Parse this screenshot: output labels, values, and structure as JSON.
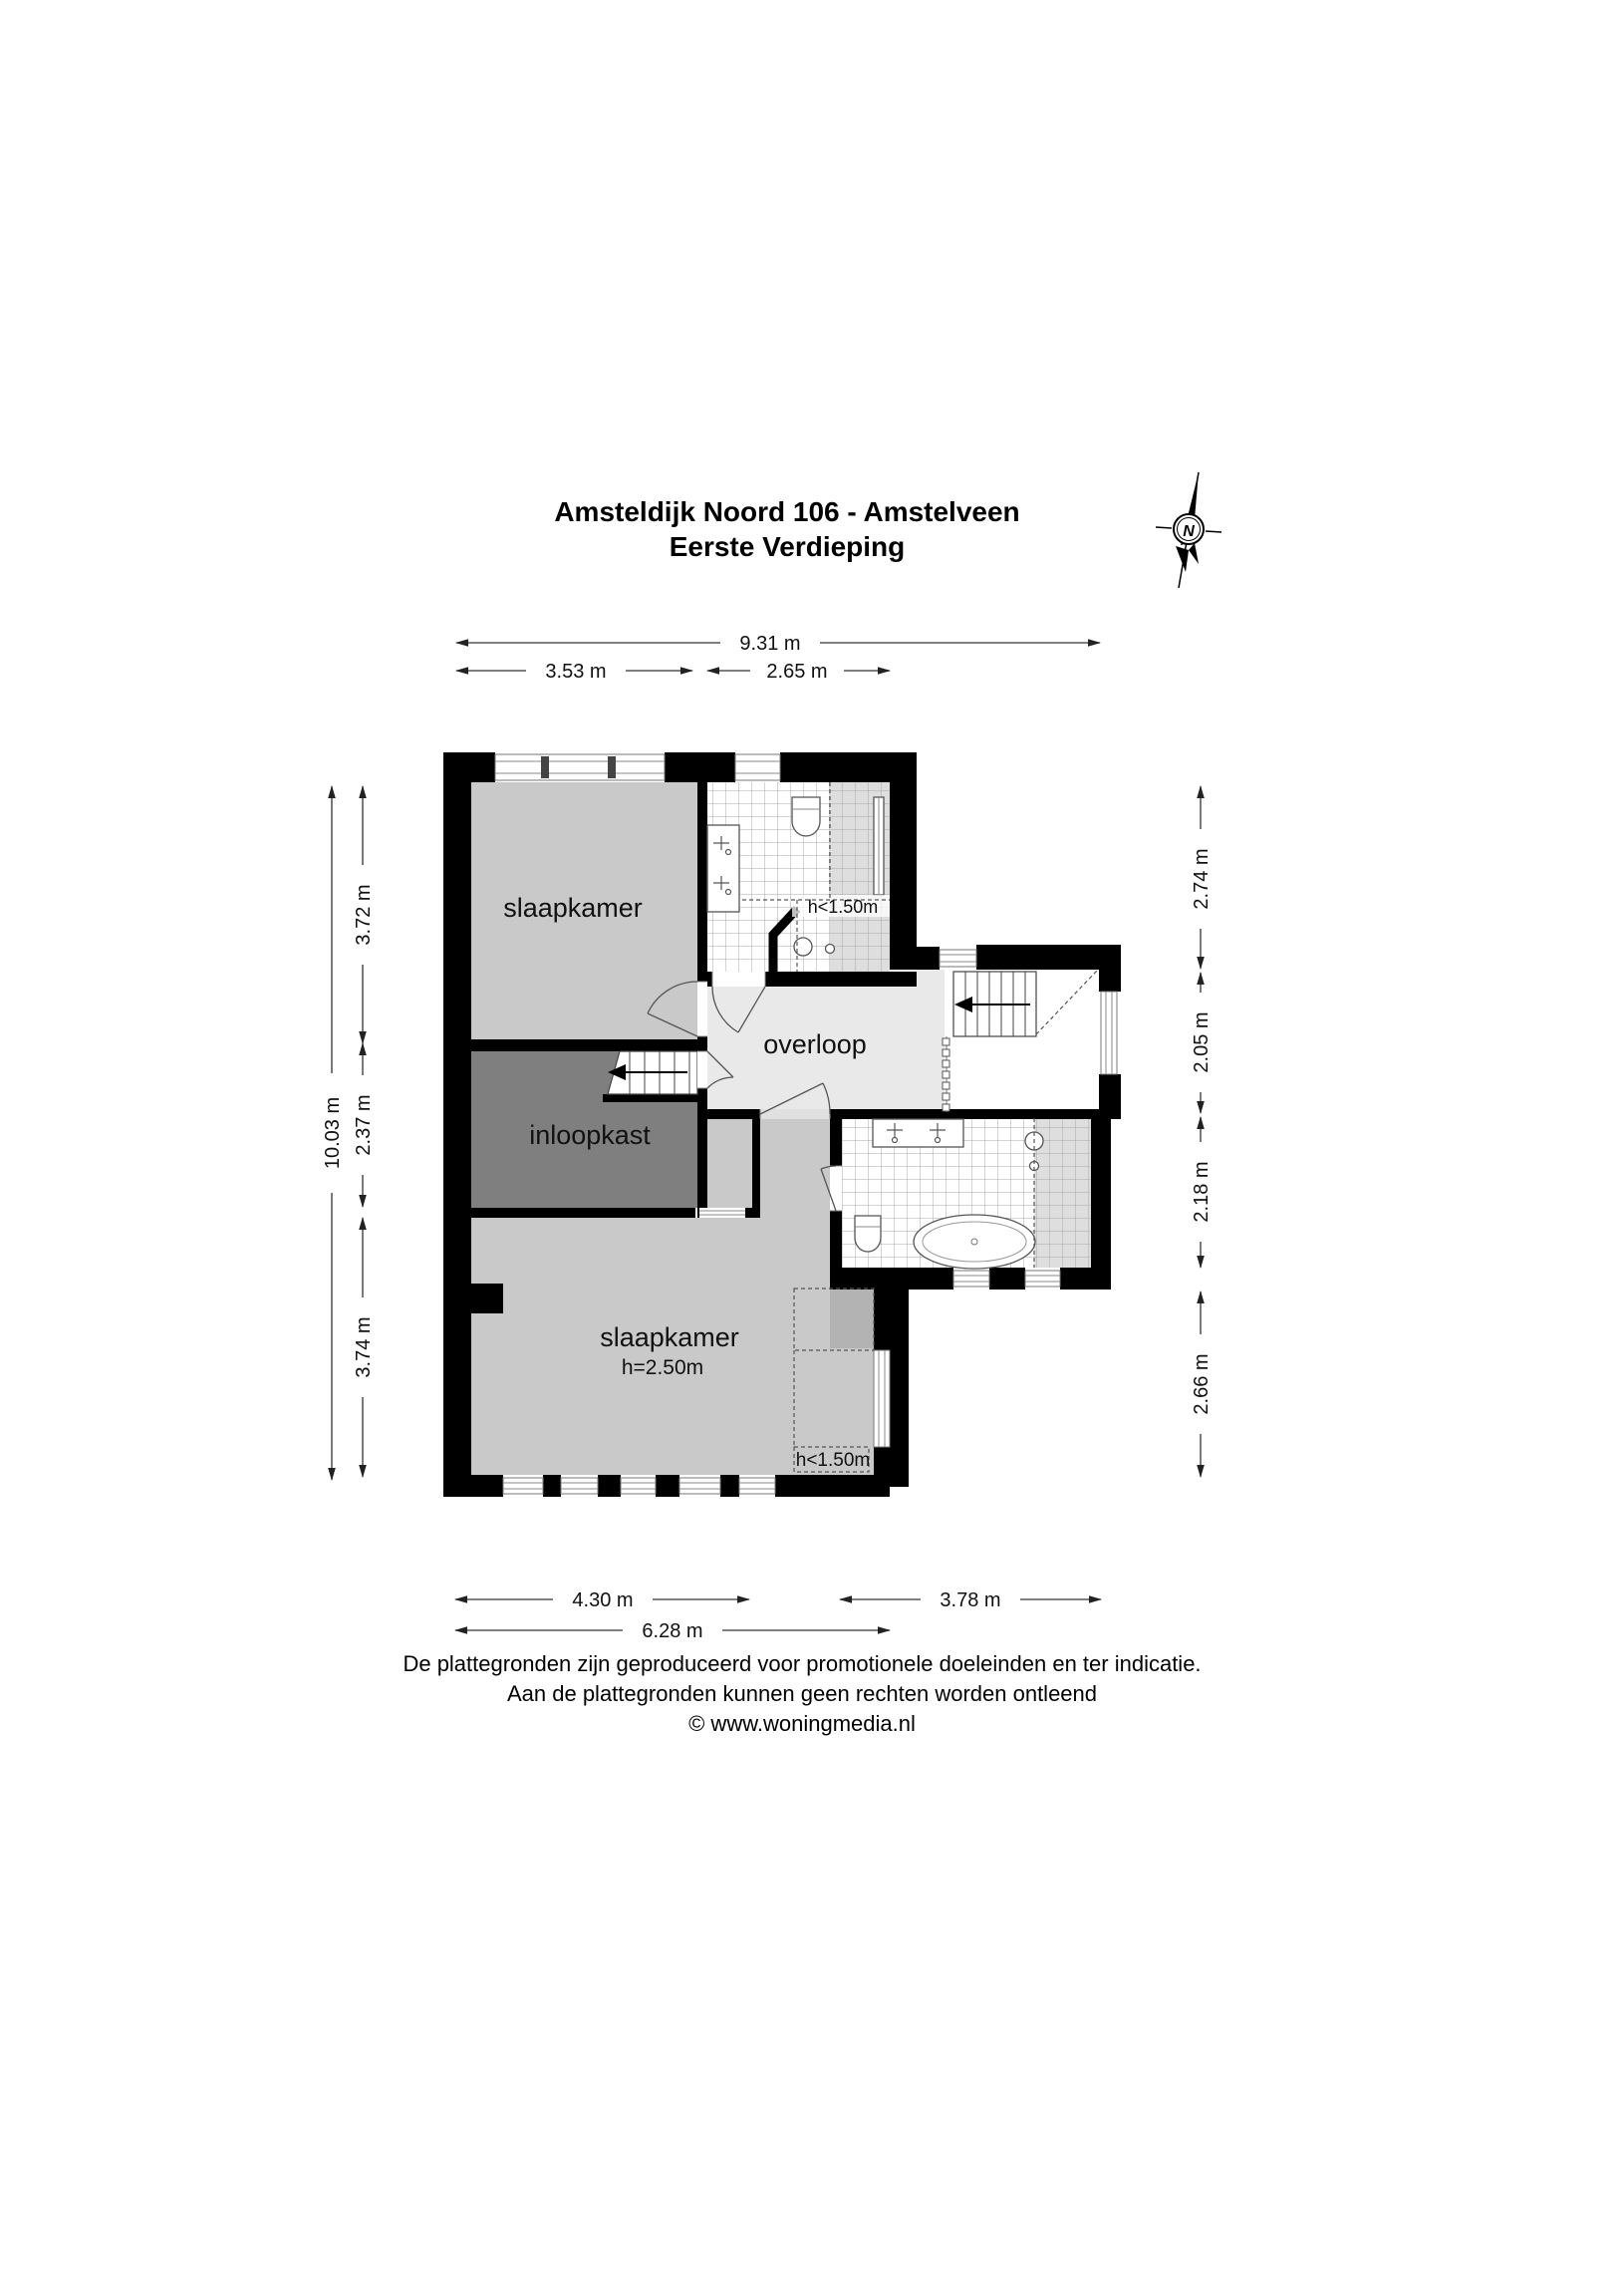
{
  "title": {
    "line1": "Amsteldijk Noord 106 - Amstelveen",
    "line2": "Eerste Verdieping"
  },
  "compass": {
    "label": "N"
  },
  "rooms": {
    "bedroom_top": {
      "label": "slaapkamer"
    },
    "landing": {
      "label": "overloop"
    },
    "closet": {
      "label": "inloopkast"
    },
    "bedroom_bottom": {
      "label": "slaapkamer",
      "ceiling_height": "h=2.50m",
      "low_ceiling": "h<1.50m"
    },
    "bathroom_top": {
      "low_ceiling": "h<1.50m"
    }
  },
  "dimensions": {
    "top_total": "9.31 m",
    "top_left": "3.53 m",
    "top_right": "2.65 m",
    "left_total": "10.03 m",
    "left_top": "3.72 m",
    "left_middle": "2.37 m",
    "left_bottom": "3.74 m",
    "right_top": "2.74 m",
    "right_upper_middle": "2.05 m",
    "right_lower_middle": "2.18 m",
    "right_bottom": "2.66 m",
    "bottom_left": "4.30 m",
    "bottom_right": "3.78 m",
    "bottom_total": "6.28 m"
  },
  "footer": {
    "line1": "De plattegronden zijn geproduceerd voor promotionele doeleinden en ter indicatie.",
    "line2": "Aan de plattegronden kunnen geen rechten worden ontleend",
    "line3": "© www.woningmedia.nl"
  },
  "colors": {
    "wall": "#000000",
    "bedroom_fill": "#c9c9c9",
    "closet_fill": "#7f7f7f",
    "landing_fill": "#e9e9e9",
    "low_ceiling_fill": "#b3b3b3",
    "tile_tint": "#dedede"
  }
}
